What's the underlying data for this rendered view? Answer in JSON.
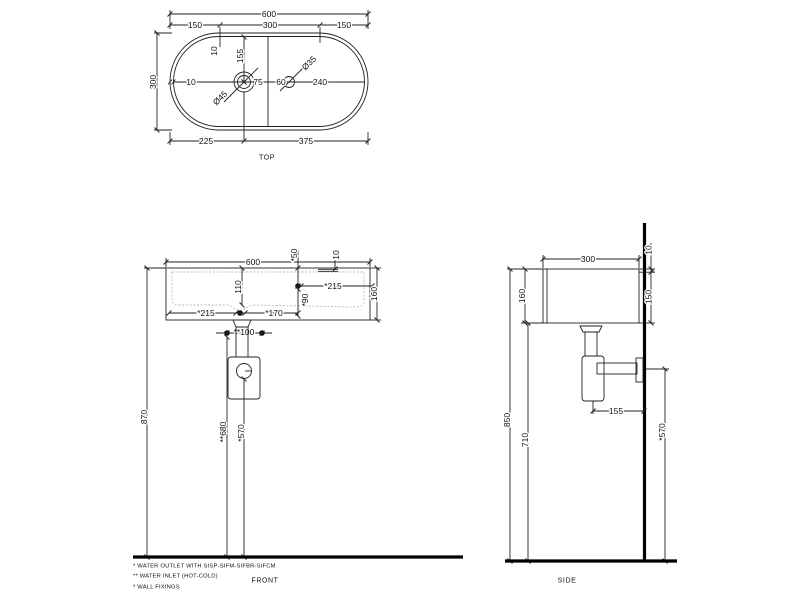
{
  "drawing": {
    "views": {
      "top": {
        "caption": "TOP",
        "dims": {
          "overall_width": "600",
          "left_segment": "150",
          "center_segment": "300",
          "right_segment": "150",
          "rim_offset_top": "10",
          "drain_center_from_top": "155",
          "overall_depth": "300",
          "rim_offset_left": "10",
          "drain_diameter": "Ø45",
          "drain_to_divider": "75",
          "divider_to_taphole": "60",
          "taphole_diameter": "Ø35",
          "taphole_to_right_edge": "240",
          "left_edge_to_drain": "225",
          "drain_to_right_edge": "375"
        }
      },
      "front": {
        "caption": "FRONT",
        "dims": {
          "overall_width": "600",
          "taphole_from_top": "*50",
          "overflow_from_top": "10",
          "bowl_depth": "110",
          "taphole_to_right_edge": "*215",
          "taphole_from_bottom": "*90",
          "basin_height": "160",
          "left_edge_to_drain": "*215",
          "drain_to_taphole": "*170",
          "inlet_spacing": "**100",
          "rim_height_from_floor": "870",
          "inlet_height_from_floor": "**680",
          "outlet_height_from_floor": "*570"
        }
      },
      "side": {
        "caption": "SIDE",
        "dims": {
          "overall_depth": "300",
          "rear_rim": "10",
          "rear_height": "150",
          "front_height": "160",
          "rim_height_from_floor": "850",
          "underside_height_from_floor": "710",
          "trap_to_wall": "155",
          "outlet_height_from_floor": "*570"
        }
      }
    },
    "notes": {
      "water_outlet": "*  WATER OUTLET WITH SISP-SIFM-SIFBR-SIFCM",
      "water_inlet": "** WATER INLET  (HOT-COLD)",
      "wall_fixings": "*  WALL FIXINGS"
    }
  }
}
